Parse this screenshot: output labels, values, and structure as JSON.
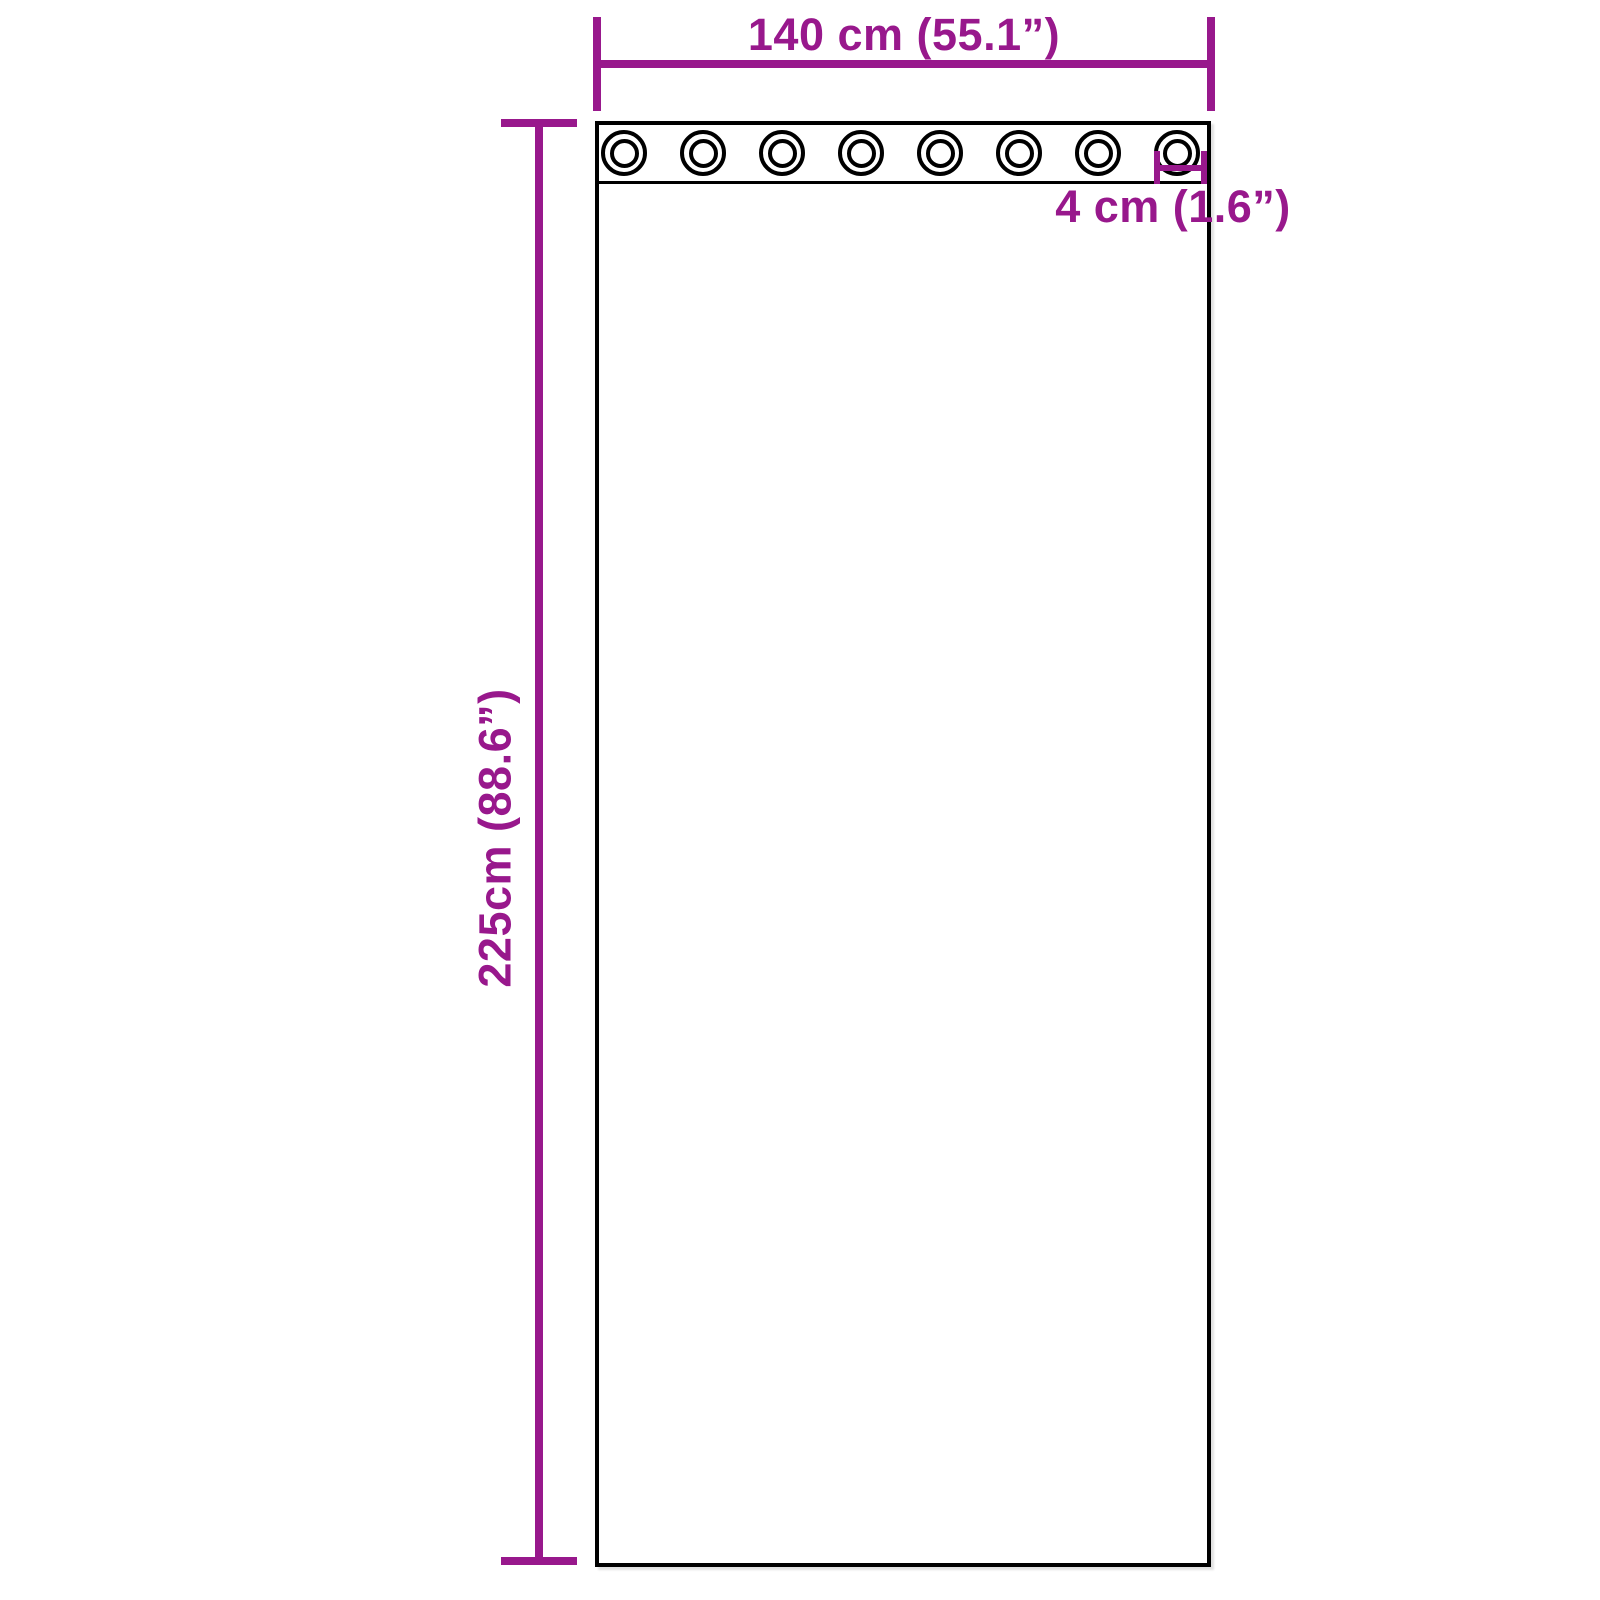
{
  "colors": {
    "dimension_accent": "#98188c",
    "outline": "#000000",
    "background": "#ffffff"
  },
  "curtain": {
    "grommet_count": 8,
    "labels": {
      "width": "140 cm (55.1”)",
      "height": "225cm (88.6”)",
      "grommet_diameter": "4 cm (1.6”)"
    }
  }
}
